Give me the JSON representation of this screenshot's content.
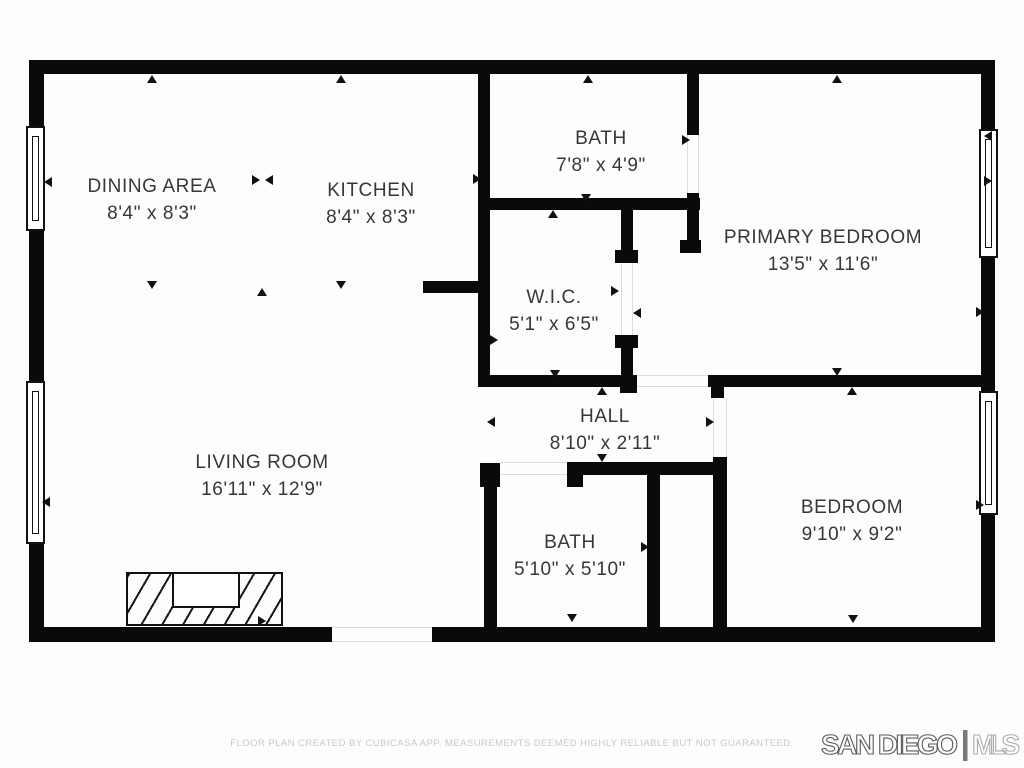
{
  "plan": {
    "title": "Residential floor plan",
    "creator_note": "FLOOR PLAN CREATED BY CUBICASA APP. MEASUREMENTS DEEMED HIGHLY RELIABLE BUT NOT GUARANTEED."
  },
  "rooms": [
    {
      "name": "DINING AREA",
      "dims": "8'4\" x 8'3\""
    },
    {
      "name": "KITCHEN",
      "dims": "8'4\" x 8'3\""
    },
    {
      "name": "BATH",
      "dims": "7'8\" x 4'9\""
    },
    {
      "name": "PRIMARY BEDROOM",
      "dims": "13'5\" x 11'6\""
    },
    {
      "name": "W.I.C.",
      "dims": "5'1\" x 6'5\""
    },
    {
      "name": "HALL",
      "dims": "8'10\" x 2'11\""
    },
    {
      "name": "LIVING ROOM",
      "dims": "16'11\" x 12'9\""
    },
    {
      "name": "BATH",
      "dims": "5'10\" x 5'10\""
    },
    {
      "name": "BEDROOM",
      "dims": "9'10\" x 9'2\""
    }
  ],
  "logo": {
    "primary": "SAN DIEGO",
    "secondary": "MLS"
  },
  "colors": {
    "wall": "#0a0a0a",
    "label_text": "#373737",
    "footer_text": "#c9c9c9",
    "logo_primary_stroke": "#5a5a5a",
    "logo_separator": "#7a7a7a",
    "logo_secondary_stroke": "#ababab",
    "background": "#fdfdfd"
  }
}
